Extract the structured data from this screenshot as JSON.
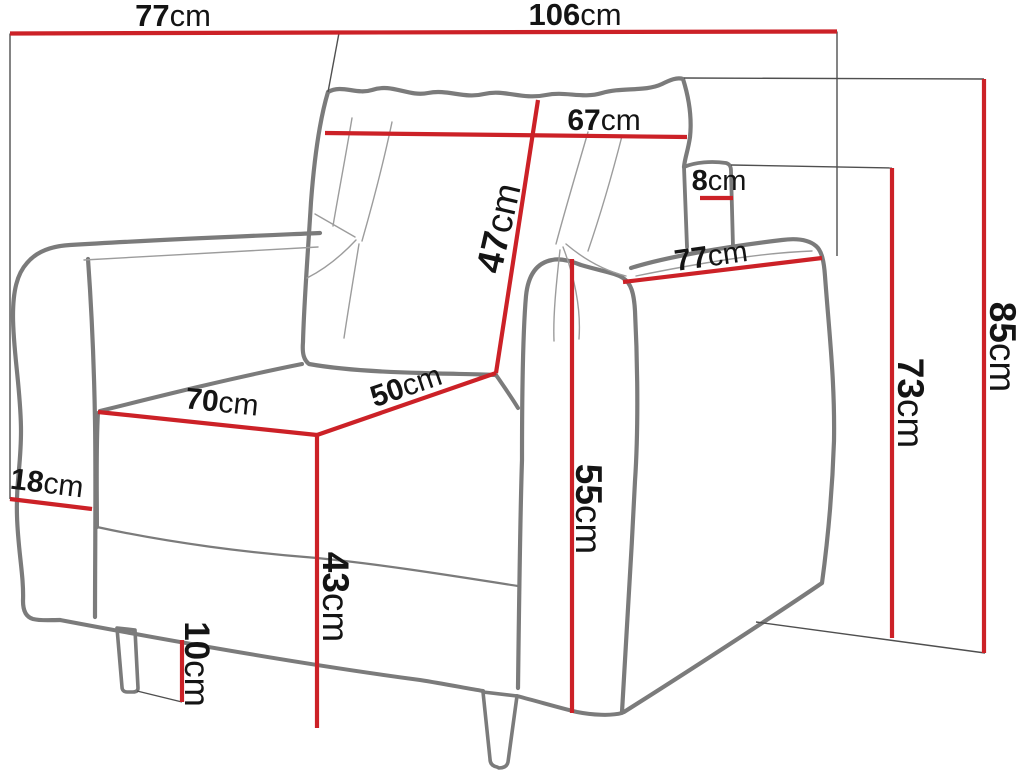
{
  "figure": {
    "kind": "furniture dimension diagram",
    "subject": "armchair line drawing with measurements",
    "unit": "cm"
  },
  "colors": {
    "dimension": "#cc2127",
    "artwork": "#7b7b7b",
    "artwork_thin": "#9c9c9c",
    "guide": "#4f4f4f",
    "text": "#141414",
    "background": "#ffffff"
  },
  "measurements": [
    {
      "id": "top-depth",
      "num": "77",
      "unit": "cm",
      "label": {
        "x": 173,
        "y": 15,
        "rot": 0,
        "size": 31
      },
      "line": {
        "x1": 10,
        "y1": 33.5,
        "x2": 339,
        "y2": 32.5
      }
    },
    {
      "id": "top-width-total",
      "num": "106",
      "unit": "cm",
      "label": {
        "x": 575,
        "y": 14,
        "rot": 0,
        "size": 31
      },
      "line": {
        "x1": 339,
        "y1": 32.5,
        "x2": 837,
        "y2": 31.5
      }
    },
    {
      "id": "back-cushion-width",
      "num": "67",
      "unit": "cm",
      "label": {
        "x": 604,
        "y": 120,
        "rot": 0,
        "size": 30
      },
      "line": {
        "x1": 325,
        "y1": 133,
        "x2": 687,
        "y2": 137
      }
    },
    {
      "id": "backrest-side-thickness",
      "num": "8",
      "unit": "cm",
      "label": {
        "x": 719,
        "y": 181,
        "rot": 0,
        "size": 29
      },
      "line": {
        "x1": 700,
        "y1": 198,
        "x2": 733,
        "y2": 198
      }
    },
    {
      "id": "armrest-depth",
      "num": "77",
      "unit": "cm",
      "label": {
        "x": 711,
        "y": 256,
        "rot": -8,
        "size": 30
      },
      "line": {
        "x1": 623,
        "y1": 282,
        "x2": 822,
        "y2": 258
      }
    },
    {
      "id": "back-cushion-height",
      "num": "47",
      "unit": "cm",
      "label": {
        "x": 498,
        "y": 228,
        "rot": -77,
        "size": 37
      },
      "line": {
        "x1": 538,
        "y1": 100,
        "x2": 496,
        "y2": 373
      }
    },
    {
      "id": "seat-depth",
      "num": "50",
      "unit": "cm",
      "label": {
        "x": 406,
        "y": 386,
        "rot": -19,
        "size": 30
      },
      "line": {
        "x1": 317,
        "y1": 435,
        "x2": 496,
        "y2": 373
      }
    },
    {
      "id": "seat-width",
      "num": "70",
      "unit": "cm",
      "label": {
        "x": 222,
        "y": 402,
        "rot": 6,
        "size": 30
      },
      "line": {
        "x1": 98,
        "y1": 412,
        "x2": 317,
        "y2": 435
      }
    },
    {
      "id": "armrest-width",
      "num": "18",
      "unit": "cm",
      "label": {
        "x": 47,
        "y": 483,
        "rot": 7,
        "size": 30
      },
      "line": {
        "x1": 10,
        "y1": 499,
        "x2": 92,
        "y2": 509
      }
    },
    {
      "id": "seat-front-height",
      "num": "43",
      "unit": "cm",
      "label": {
        "x": 336,
        "y": 597,
        "rot": 90,
        "size": 37
      },
      "line": {
        "x1": 317,
        "y1": 435,
        "x2": 317,
        "y2": 728
      }
    },
    {
      "id": "armrest-front-height",
      "num": "55",
      "unit": "cm",
      "label": {
        "x": 589,
        "y": 509,
        "rot": 90,
        "size": 37
      },
      "line": {
        "x1": 572,
        "y1": 259,
        "x2": 572,
        "y2": 713
      }
    },
    {
      "id": "leg-height",
      "num": "10",
      "unit": "cm",
      "label": {
        "x": 197,
        "y": 664,
        "rot": 90,
        "size": 35
      },
      "line": {
        "x1": 182,
        "y1": 640,
        "x2": 182,
        "y2": 702
      }
    },
    {
      "id": "backrest-height",
      "num": "73",
      "unit": "cm",
      "label": {
        "x": 911,
        "y": 403,
        "rot": 90,
        "size": 37
      },
      "line": {
        "x1": 892,
        "y1": 168,
        "x2": 892,
        "y2": 638
      }
    },
    {
      "id": "total-height",
      "num": "85",
      "unit": "cm",
      "label": {
        "x": 1003,
        "y": 347,
        "rot": 90,
        "size": 37
      },
      "line": {
        "x1": 984,
        "y1": 79,
        "x2": 984,
        "y2": 653
      }
    }
  ],
  "guides": [
    {
      "id": "left-extension",
      "x1": 10,
      "y1": 33.5,
      "x2": 10,
      "y2": 499
    },
    {
      "id": "top-split-tick",
      "x1": 339,
      "y1": 33,
      "x2": 328,
      "y2": 92
    },
    {
      "id": "right-extension",
      "x1": 837,
      "y1": 31.5,
      "x2": 837,
      "y2": 256
    },
    {
      "id": "backrest-top-ref",
      "x1": 731,
      "y1": 165,
      "x2": 892,
      "y2": 168
    },
    {
      "id": "total-height-ref",
      "x1": 684,
      "y1": 78,
      "x2": 984,
      "y2": 79
    },
    {
      "id": "floor-ref",
      "x1": 756,
      "y1": 622,
      "x2": 985,
      "y2": 653
    },
    {
      "id": "leg-bottom-ref",
      "x1": 137,
      "y1": 691,
      "x2": 182,
      "y2": 702
    }
  ]
}
